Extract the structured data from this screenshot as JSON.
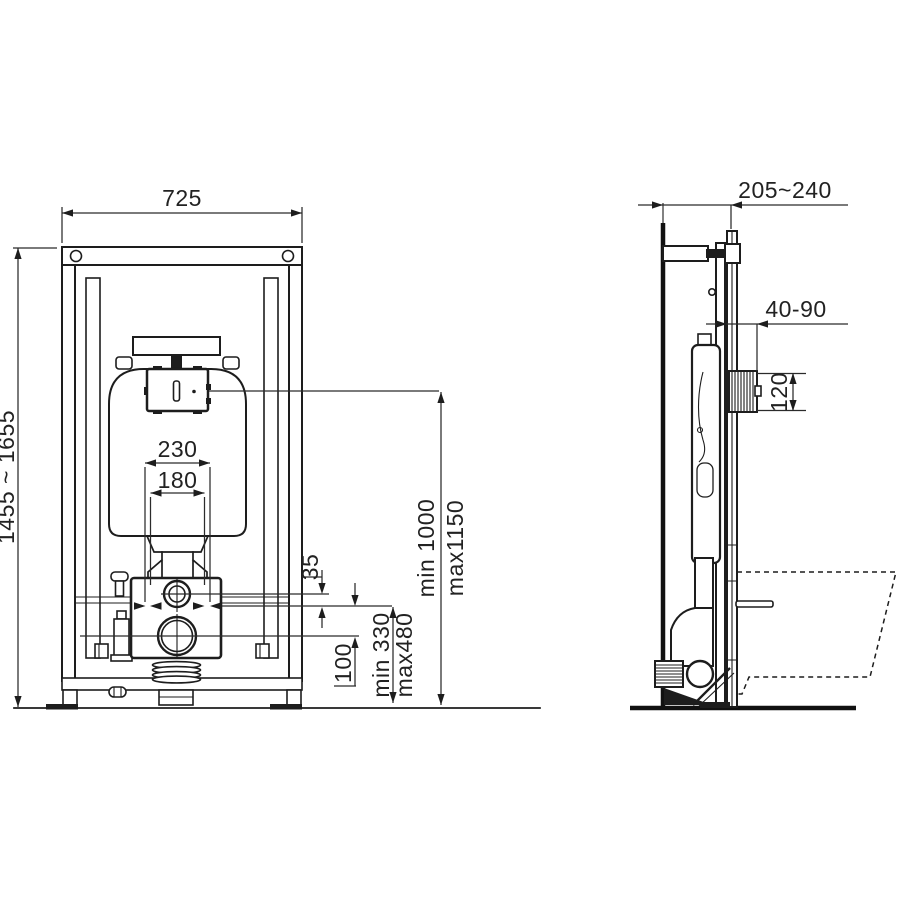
{
  "drawing": {
    "background": "#ffffff",
    "ink": "#1d1d1d",
    "type": "wall-hung WC installation frame, two orthographic views"
  },
  "front_view": {
    "dim_width": "725",
    "dim_height": "1455 ~ 1655",
    "dim_stud_spacing": "230",
    "dim_pipe_spacing": "180",
    "dim_stud_to_flush_offset": "35",
    "dim_stud_to_outlet_offset": "100",
    "dim_outlet_height_min": "min 330",
    "dim_outlet_height_max": "max480",
    "dim_flush_panel_height_min": "min 1000",
    "dim_flush_panel_height_max": "max1150"
  },
  "side_view": {
    "dim_depth": "205~240",
    "dim_sleeve_projection": "40-90",
    "dim_inlet_sleeve_height": "120"
  }
}
